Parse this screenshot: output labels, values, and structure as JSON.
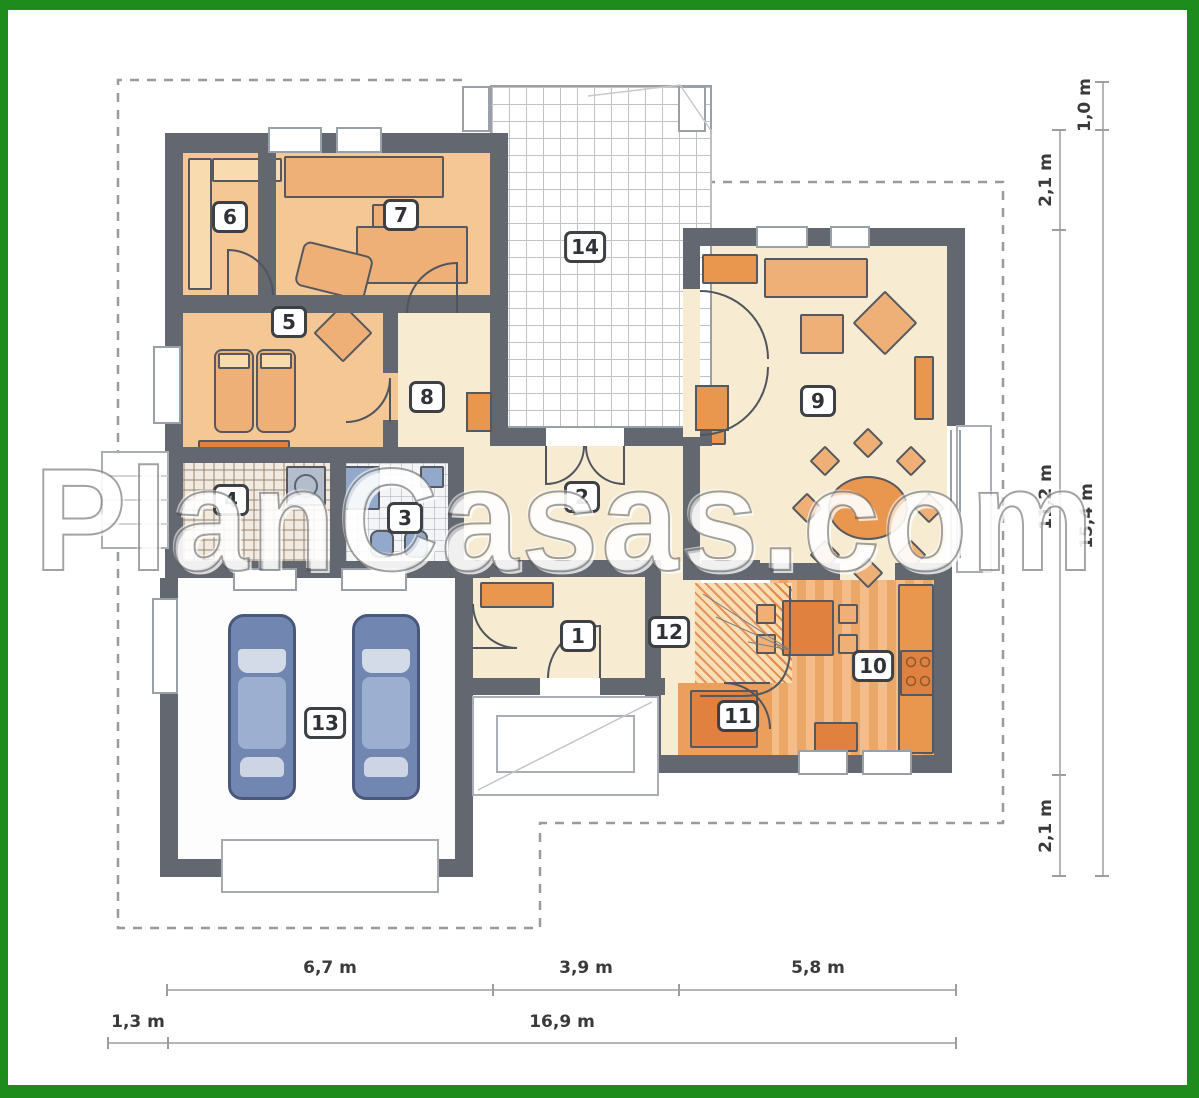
{
  "watermark": {
    "text": "PlanCasas.com"
  },
  "rooms": [
    {
      "id": "room-1",
      "label": "1",
      "x": 578,
      "y": 636
    },
    {
      "id": "room-2",
      "label": "2",
      "x": 582,
      "y": 497
    },
    {
      "id": "room-3",
      "label": "3",
      "x": 405,
      "y": 518
    },
    {
      "id": "room-4",
      "label": "4",
      "x": 231,
      "y": 500
    },
    {
      "id": "room-5",
      "label": "5",
      "x": 289,
      "y": 322
    },
    {
      "id": "room-6",
      "label": "6",
      "x": 230,
      "y": 217
    },
    {
      "id": "room-7",
      "label": "7",
      "x": 401,
      "y": 215
    },
    {
      "id": "room-8",
      "label": "8",
      "x": 427,
      "y": 397
    },
    {
      "id": "room-9",
      "label": "9",
      "x": 818,
      "y": 401
    },
    {
      "id": "room-10",
      "label": "10",
      "x": 873,
      "y": 666
    },
    {
      "id": "room-11",
      "label": "11",
      "x": 738,
      "y": 716
    },
    {
      "id": "room-12",
      "label": "12",
      "x": 669,
      "y": 632
    },
    {
      "id": "room-13",
      "label": "13",
      "x": 325,
      "y": 723
    },
    {
      "id": "room-14",
      "label": "14",
      "x": 585,
      "y": 247
    }
  ],
  "dimensions": {
    "bottom_upper": [
      {
        "label": "6,7 m"
      },
      {
        "label": "3,9 m"
      },
      {
        "label": "5,8 m"
      }
    ],
    "bottom_lower": [
      {
        "label": "1,3 m"
      },
      {
        "label": "16,9 m"
      }
    ],
    "right_inner": [
      {
        "label": "2,1 m"
      },
      {
        "label": "11,2 m"
      },
      {
        "label": "2,1 m"
      }
    ],
    "right_outer": [
      {
        "label": "1,0 m"
      },
      {
        "label": "15,4 m"
      }
    ]
  },
  "colors": {
    "frame_green": "#1d8c1d",
    "wall_gray": "#63676f",
    "bedroom_floor": "#f4c794",
    "cream_floor": "#f7ecd2",
    "furniture_tan": "#eeb077",
    "accent_orange": "#e9964f",
    "deep_orange": "#e0813f",
    "kitchen_stripe_a": "#f3bc88",
    "kitchen_stripe_b": "#eaa768",
    "car_blue": "#7187b1",
    "fixture_blue": "#93a9cc",
    "dimension_gray": "#3a3a3a"
  }
}
